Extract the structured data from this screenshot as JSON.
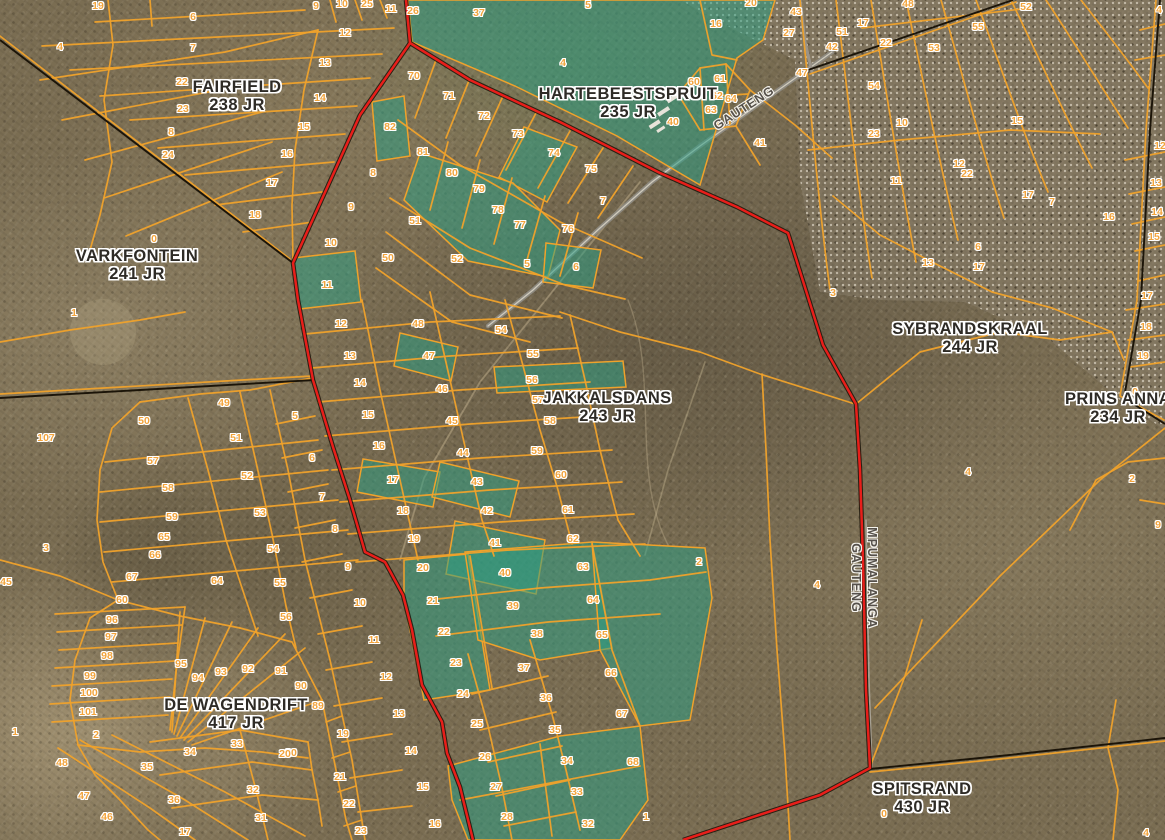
{
  "map": {
    "colors": {
      "parcel_line": "#f0a22b",
      "farm_line": "#1b1408",
      "province_line": "#e81e1a",
      "selection_fill": "#2aa085",
      "road": "#9a948a",
      "number_text": "#f2a43c",
      "farm_text": "#2e2b26"
    },
    "farm_labels": [
      {
        "line1": "FAIRFIELD",
        "line2": "238 JR",
        "x": 237,
        "y": 96
      },
      {
        "line1": "VARKFONTEIN",
        "line2": "241 JR",
        "x": 137,
        "y": 265
      },
      {
        "line1": "HARTEBEESTSPRUIT",
        "line2": "235 JR",
        "x": 628,
        "y": 103
      },
      {
        "line1": "SYBRANDSKRAAL",
        "line2": "244 JR",
        "x": 970,
        "y": 338
      },
      {
        "line1": "PRINS ANNA",
        "line2": "234 JR",
        "x": 1118,
        "y": 408
      },
      {
        "line1": "JAKKALSDANS",
        "line2": "243 JR",
        "x": 607,
        "y": 407
      },
      {
        "line1": "DE WAGENDRIFT",
        "line2": "417 JR",
        "x": 236,
        "y": 714
      },
      {
        "line1": "SPITSRAND",
        "line2": "430 JR",
        "x": 922,
        "y": 798
      }
    ],
    "boundary_labels": [
      {
        "text": "GAUTENG",
        "x": 744,
        "y": 108,
        "rot": -33
      },
      {
        "text": "MPUMALANGA",
        "x": 872,
        "y": 578,
        "rot": 90
      },
      {
        "text": "GAUTENG",
        "x": 856,
        "y": 578,
        "rot": 90
      }
    ],
    "parcel_labels": [
      [
        "19",
        98,
        6
      ],
      [
        "6",
        193,
        17
      ],
      [
        "4",
        60,
        47
      ],
      [
        "7",
        193,
        48
      ],
      [
        "22",
        182,
        82
      ],
      [
        "23",
        183,
        109
      ],
      [
        "8",
        171,
        132
      ],
      [
        "24",
        168,
        155
      ],
      [
        "0",
        154,
        239
      ],
      [
        "1",
        74,
        313
      ],
      [
        "107",
        46,
        438
      ],
      [
        "3",
        46,
        548
      ],
      [
        "45",
        6,
        582
      ],
      [
        "9",
        316,
        6
      ],
      [
        "10",
        342,
        4
      ],
      [
        "25",
        367,
        4
      ],
      [
        "11",
        391,
        9
      ],
      [
        "26",
        413,
        11
      ],
      [
        "12",
        345,
        33
      ],
      [
        "13",
        325,
        63
      ],
      [
        "14",
        320,
        98
      ],
      [
        "15",
        304,
        127
      ],
      [
        "16",
        287,
        154
      ],
      [
        "17",
        272,
        183
      ],
      [
        "18",
        255,
        215
      ],
      [
        "82",
        390,
        127
      ],
      [
        "8",
        373,
        173
      ],
      [
        "9",
        351,
        207
      ],
      [
        "10",
        331,
        243
      ],
      [
        "50",
        388,
        258
      ],
      [
        "11",
        327,
        285
      ],
      [
        "37",
        479,
        13
      ],
      [
        "5",
        588,
        5
      ],
      [
        "4",
        563,
        63
      ],
      [
        "20",
        751,
        3
      ],
      [
        "16",
        716,
        24
      ],
      [
        "43",
        796,
        12
      ],
      [
        "27",
        789,
        33
      ],
      [
        "47",
        802,
        73
      ],
      [
        "70",
        414,
        76
      ],
      [
        "71",
        449,
        96
      ],
      [
        "72",
        484,
        116
      ],
      [
        "73",
        518,
        134
      ],
      [
        "74",
        554,
        153
      ],
      [
        "75",
        591,
        169
      ],
      [
        "7",
        603,
        201
      ],
      [
        "81",
        423,
        152
      ],
      [
        "80",
        452,
        173
      ],
      [
        "79",
        479,
        189
      ],
      [
        "78",
        498,
        210
      ],
      [
        "77",
        520,
        225
      ],
      [
        "76",
        568,
        229
      ],
      [
        "51",
        415,
        221
      ],
      [
        "52",
        457,
        259
      ],
      [
        "5",
        527,
        264
      ],
      [
        "6",
        576,
        267
      ],
      [
        "60",
        694,
        82
      ],
      [
        "61",
        720,
        79
      ],
      [
        "62",
        717,
        96
      ],
      [
        "63",
        711,
        110
      ],
      [
        "64",
        731,
        99
      ],
      [
        "40",
        673,
        122
      ],
      [
        "41",
        760,
        143
      ],
      [
        "3",
        833,
        293
      ],
      [
        "48",
        908,
        4
      ],
      [
        "52",
        1026,
        7
      ],
      [
        "17",
        863,
        23
      ],
      [
        "51",
        842,
        32
      ],
      [
        "42",
        832,
        47
      ],
      [
        "22",
        886,
        43
      ],
      [
        "55",
        978,
        27
      ],
      [
        "53",
        934,
        48
      ],
      [
        "54",
        874,
        86
      ],
      [
        "10",
        902,
        123
      ],
      [
        "23",
        874,
        134
      ],
      [
        "15",
        1017,
        121
      ],
      [
        "12",
        959,
        164
      ],
      [
        "22",
        967,
        174
      ],
      [
        "11",
        896,
        181
      ],
      [
        "17",
        1028,
        195
      ],
      [
        "7",
        1052,
        202
      ],
      [
        "16",
        1109,
        217
      ],
      [
        "6",
        978,
        247
      ],
      [
        "13",
        928,
        263
      ],
      [
        "17",
        979,
        267
      ],
      [
        "4",
        1159,
        10
      ],
      [
        "12",
        1160,
        146
      ],
      [
        "13",
        1156,
        183
      ],
      [
        "14",
        1157,
        212
      ],
      [
        "15",
        1154,
        237
      ],
      [
        "17",
        1147,
        296
      ],
      [
        "18",
        1146,
        327
      ],
      [
        "19",
        1143,
        356
      ],
      [
        "0",
        1135,
        392
      ],
      [
        "2",
        1132,
        479
      ],
      [
        "9",
        1158,
        525
      ],
      [
        "4",
        968,
        472
      ],
      [
        "4",
        817,
        585
      ],
      [
        "2",
        699,
        562
      ],
      [
        "12",
        341,
        324
      ],
      [
        "13",
        350,
        356
      ],
      [
        "14",
        360,
        383
      ],
      [
        "15",
        368,
        415
      ],
      [
        "16",
        379,
        446
      ],
      [
        "17",
        393,
        480
      ],
      [
        "18",
        403,
        511
      ],
      [
        "19",
        414,
        539
      ],
      [
        "20",
        423,
        568
      ],
      [
        "5",
        295,
        416
      ],
      [
        "6",
        312,
        458
      ],
      [
        "7",
        322,
        497
      ],
      [
        "8",
        335,
        529
      ],
      [
        "9",
        348,
        567
      ],
      [
        "48",
        418,
        324
      ],
      [
        "47",
        429,
        356
      ],
      [
        "46",
        442,
        389
      ],
      [
        "45",
        452,
        421
      ],
      [
        "44",
        463,
        453
      ],
      [
        "43",
        477,
        482
      ],
      [
        "42",
        487,
        511
      ],
      [
        "41",
        495,
        543
      ],
      [
        "40",
        505,
        573
      ],
      [
        "54",
        501,
        330
      ],
      [
        "55",
        533,
        354
      ],
      [
        "56",
        532,
        380
      ],
      [
        "57",
        538,
        400
      ],
      [
        "58",
        550,
        421
      ],
      [
        "59",
        537,
        451
      ],
      [
        "60",
        561,
        475
      ],
      [
        "61",
        568,
        510
      ],
      [
        "62",
        573,
        539
      ],
      [
        "63",
        583,
        567
      ],
      [
        "64",
        593,
        600
      ],
      [
        "49",
        224,
        403
      ],
      [
        "50",
        144,
        421
      ],
      [
        "51",
        236,
        438
      ],
      [
        "52",
        247,
        476
      ],
      [
        "53",
        260,
        513
      ],
      [
        "54",
        273,
        549
      ],
      [
        "55",
        280,
        583
      ],
      [
        "56",
        286,
        617
      ],
      [
        "57",
        153,
        461
      ],
      [
        "58",
        168,
        488
      ],
      [
        "59",
        172,
        517
      ],
      [
        "65",
        164,
        537
      ],
      [
        "66",
        155,
        555
      ],
      [
        "67",
        132,
        577
      ],
      [
        "64",
        217,
        581
      ],
      [
        "60",
        122,
        600
      ],
      [
        "21",
        433,
        601
      ],
      [
        "39",
        513,
        606
      ],
      [
        "22",
        444,
        632
      ],
      [
        "38",
        537,
        634
      ],
      [
        "23",
        456,
        663
      ],
      [
        "37",
        524,
        668
      ],
      [
        "65",
        602,
        635
      ],
      [
        "66",
        611,
        673
      ],
      [
        "24",
        463,
        694
      ],
      [
        "36",
        546,
        698
      ],
      [
        "67",
        622,
        714
      ],
      [
        "25",
        477,
        724
      ],
      [
        "35",
        555,
        730
      ],
      [
        "26",
        485,
        757
      ],
      [
        "34",
        567,
        761
      ],
      [
        "68",
        633,
        762
      ],
      [
        "27",
        496,
        787
      ],
      [
        "33",
        577,
        792
      ],
      [
        "28",
        507,
        817
      ],
      [
        "32",
        588,
        824
      ],
      [
        "1",
        646,
        817
      ],
      [
        "10",
        360,
        603
      ],
      [
        "11",
        374,
        640
      ],
      [
        "12",
        386,
        677
      ],
      [
        "13",
        399,
        714
      ],
      [
        "14",
        411,
        751
      ],
      [
        "15",
        423,
        787
      ],
      [
        "16",
        435,
        824
      ],
      [
        "19",
        343,
        734
      ],
      [
        "20",
        291,
        753
      ],
      [
        "21",
        340,
        777
      ],
      [
        "22",
        349,
        804
      ],
      [
        "23",
        361,
        831
      ],
      [
        "91",
        281,
        671
      ],
      [
        "90",
        301,
        686
      ],
      [
        "89",
        318,
        706
      ],
      [
        "96",
        112,
        620
      ],
      [
        "97",
        111,
        637
      ],
      [
        "98",
        107,
        656
      ],
      [
        "99",
        90,
        676
      ],
      [
        "100",
        89,
        693
      ],
      [
        "101",
        88,
        712
      ],
      [
        "2",
        96,
        735
      ],
      [
        "1",
        15,
        732
      ],
      [
        "95",
        181,
        664
      ],
      [
        "94",
        198,
        678
      ],
      [
        "93",
        221,
        672
      ],
      [
        "92",
        248,
        669
      ],
      [
        "48",
        62,
        763
      ],
      [
        "47",
        84,
        796
      ],
      [
        "46",
        107,
        817
      ],
      [
        "35",
        147,
        767
      ],
      [
        "36",
        174,
        800
      ],
      [
        "34",
        190,
        752
      ],
      [
        "33",
        237,
        744
      ],
      [
        "32",
        253,
        790
      ],
      [
        "31",
        261,
        818
      ],
      [
        "20",
        285,
        754
      ],
      [
        "17",
        185,
        832
      ],
      [
        "0",
        884,
        814
      ],
      [
        "4",
        1146,
        833
      ]
    ]
  }
}
